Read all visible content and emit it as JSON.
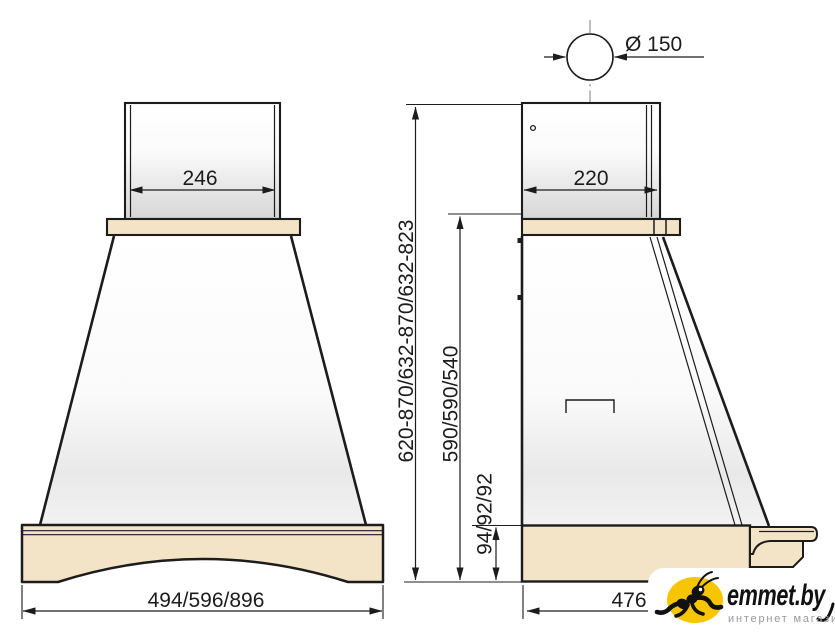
{
  "drawing": {
    "title": "cooker-hood dimension drawing",
    "front": {
      "duct_width": "246",
      "base_width": "494/596/896"
    },
    "side": {
      "duct_depth": "220",
      "base_depth": "476",
      "flue_diameter": "Ø 150",
      "overall_height": "620-870/632-870/632-823",
      "body_height": "590/590/540",
      "base_height": "94/92/92"
    }
  },
  "logo": {
    "brand": "emmet.by",
    "tagline": "интернет магазин"
  },
  "colors": {
    "line": "#1c1c1c",
    "wood_beige": "#f4e4c7",
    "centerline_gray": "#8a8a8a",
    "logo_yellow": "#f7c600",
    "tagline_gray": "#9a9a9a"
  }
}
